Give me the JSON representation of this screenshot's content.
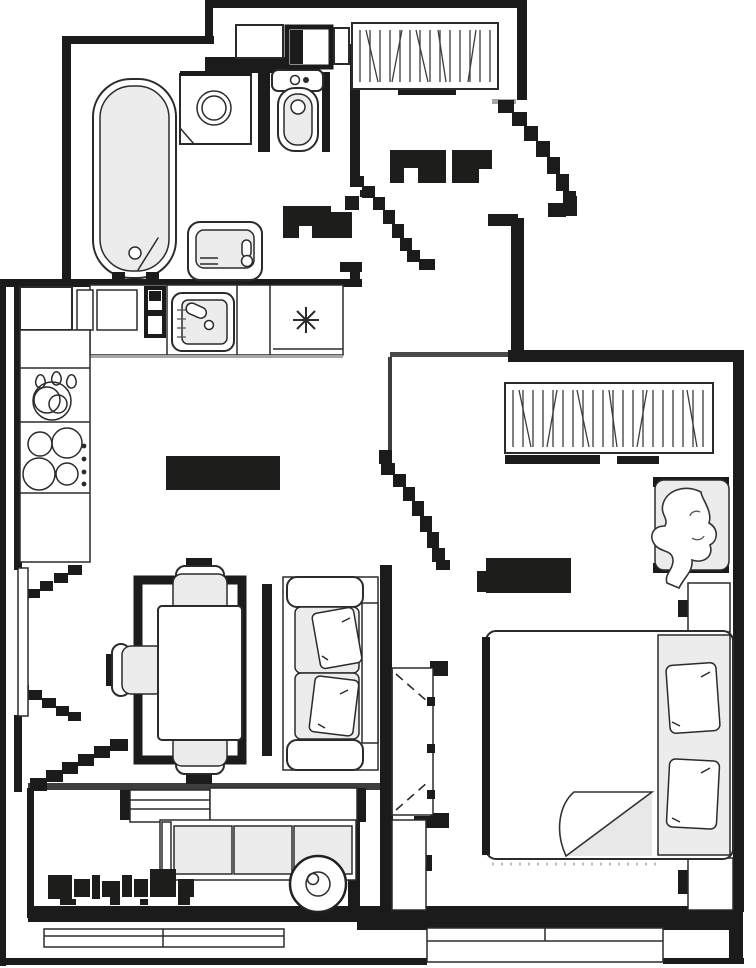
{
  "title": "apartment-floor-plan",
  "colors": {
    "bg": "#ffffff",
    "wall": "#1b1b1c",
    "line": "#2b2b2b",
    "soft": "#555555",
    "fill": "#ececec",
    "muted": "#b5b5b5"
  },
  "rooms": [
    {
      "id": "bathroom",
      "label_text": "",
      "label_legible": false
    },
    {
      "id": "hallway",
      "label_text": "",
      "label_legible": false
    },
    {
      "id": "kitchen-living-room",
      "label_text": "",
      "label_legible": false
    },
    {
      "id": "bedroom",
      "label_text": "",
      "label_legible": false
    },
    {
      "id": "balcony",
      "label_text": "",
      "label_legible": false
    }
  ],
  "fixtures": [
    "bathtub",
    "washing-machine",
    "toilet",
    "washbasin",
    "entry-wardrobe",
    "kitchen-sink",
    "snowflake-fridge-symbol",
    "dish-rack",
    "cooktop",
    "dining-table",
    "dining-chairs",
    "tv-panel",
    "sofa",
    "sofa-pillows",
    "window-casements",
    "bedroom-wardrobe",
    "armchair-with-blanket",
    "nightstands",
    "double-bed",
    "bed-pillows",
    "folding-closet",
    "balcony-bench",
    "balcony-round-table",
    "balcony-railing",
    "door-swing-arcs"
  ],
  "note": "All room labels in the source are illegible rasterized black pixel blobs; no readable text exists in the image."
}
